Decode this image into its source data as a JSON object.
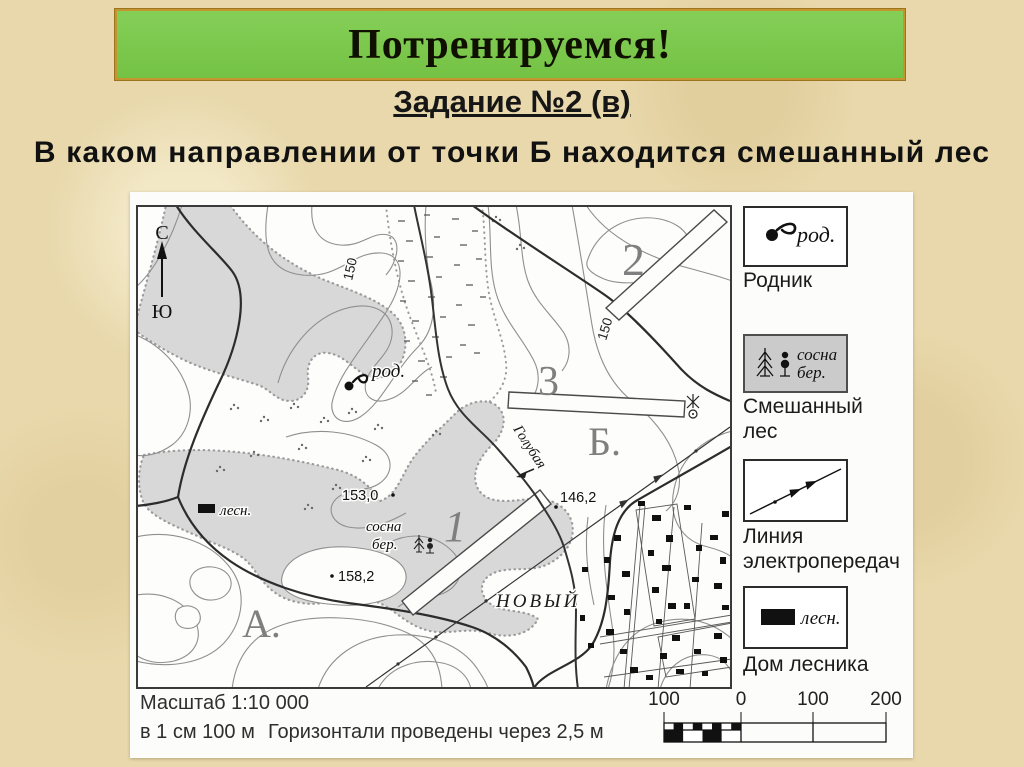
{
  "slide": {
    "title": "Потренируемся!",
    "subtitle": "Задание №2 (в)",
    "question": "В каком направлении от точки Б находится смешанный лес"
  },
  "colors": {
    "banner_green": "#7cc94c",
    "banner_border": "#c4952f",
    "background_parchment": "#e8d8ab",
    "forest_gray": "#d8d8d8",
    "contour_gray": "#8f8f8f",
    "map_ink": "#2c2c2c"
  },
  "map": {
    "compass_north": "С",
    "compass_south": "Ю",
    "contour_label_left": "150",
    "contour_label_right": "150",
    "spring_label": "род.",
    "heights": {
      "h153": "153,0",
      "h146": "146,2",
      "h158": "158,2"
    },
    "species": {
      "pine": "сосна",
      "birch": "бер."
    },
    "forester_label": "лесн.",
    "river_name": "Голубая",
    "village_name": "НОВЫЙ",
    "markers": {
      "a": "А.",
      "b": "Б.",
      "n1": "1",
      "n2": "2",
      "n3": "3"
    }
  },
  "legend": {
    "spring": {
      "symbol_label": "род.",
      "caption": "Родник"
    },
    "mixed_forest": {
      "pine": "сосна",
      "birch": "бер.",
      "caption": "Смешанный лес"
    },
    "power_line": {
      "caption": "Линия электропередач"
    },
    "forester_house": {
      "symbol_label": "лесн.",
      "caption": "Дом лесника"
    }
  },
  "footer": {
    "scale_title": "Масштаб 1:10 000",
    "scale_cm": "в 1 см 100 м",
    "contour_interval": "Горизонтали проведены через 2,5 м",
    "scalebar": [
      "100",
      "0",
      "100",
      "200"
    ]
  }
}
